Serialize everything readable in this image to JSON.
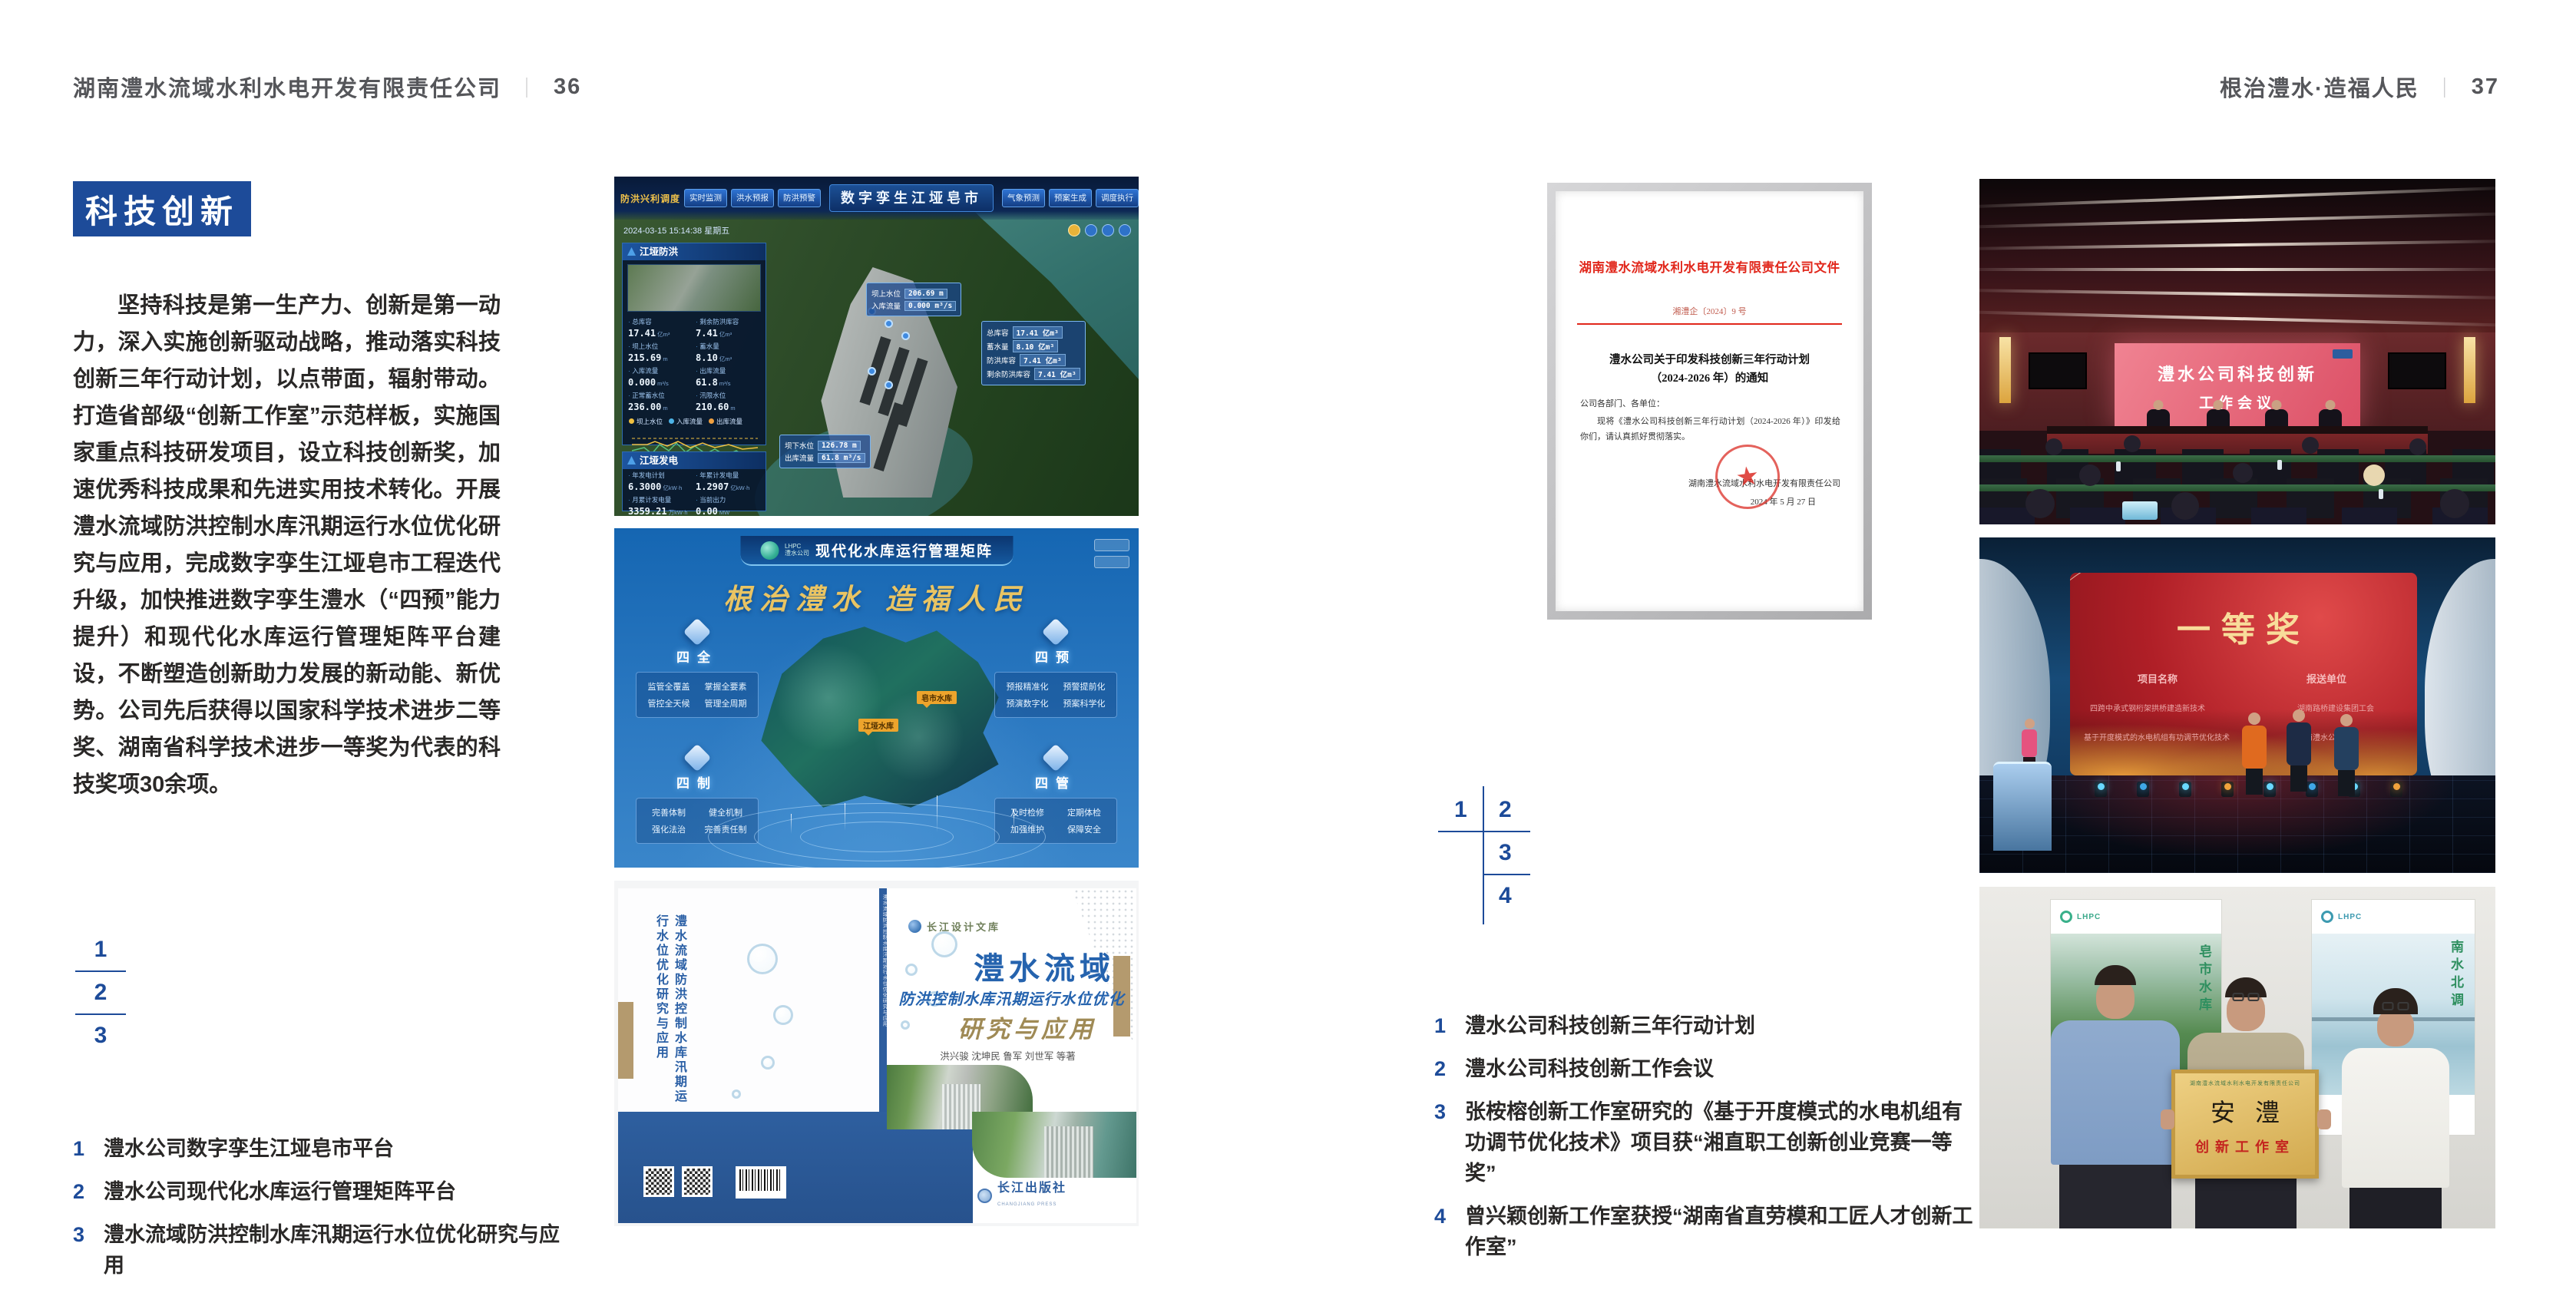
{
  "header_left": {
    "company": "湖南澧水流域水利水电开发有限责任公司",
    "separator": "｜",
    "page": "36"
  },
  "header_right": {
    "slogan": "根治澧水·造福人民",
    "separator": "｜",
    "page": "37"
  },
  "left_page": {
    "section_title": "科技创新",
    "paragraph": "坚持科技是第一生产力、创新是第一动力，深入实施创新驱动战略，推动落实科技创新三年行动计划，以点带面，辐射带动。打造省部级“创新工作室”示范样板，实施国家重点科技研发项目，设立科技创新奖，加速优秀科技成果和先进实用技术转化。开展澧水流域防洪控制水库汛期运行水位优化研究与应用，完成数字孪生江垭皂市工程迭代升级，加快推进数字孪生澧水（“四预”能力提升）和现代化水库运行管理矩阵平台建设，不断塑造创新助力发展的新动能、新优势。公司先后获得以国家科学技术进步二等奖、湖南省科学技术进步一等奖为代表的科技奖项30余项。",
    "figure_numbers": [
      "1",
      "2",
      "3"
    ],
    "captions": [
      {
        "num": "1",
        "text": "澧水公司数字孪生江垭皂市平台"
      },
      {
        "num": "2",
        "text": "澧水公司现代化水库运行管理矩阵平台"
      },
      {
        "num": "3",
        "text": "澧水流域防洪控制水库汛期运行水位优化研究与应用"
      }
    ]
  },
  "right_page": {
    "figure_numbers": [
      "1",
      "2",
      "3",
      "4"
    ],
    "captions": [
      {
        "num": "1",
        "text": "澧水公司科技创新三年行动计划"
      },
      {
        "num": "2",
        "text": "澧水公司科技创新工作会议"
      },
      {
        "num": "3",
        "text": "张桉榕创新工作室研究的《基于开度模式的水电机组有功调节优化技术》项目获“湘直职工创新创业竞赛一等奖”"
      },
      {
        "num": "4",
        "text": "曾兴颖创新工作室获授“湖南省直劳模和工匠人才创新工作室”"
      }
    ]
  },
  "fig_digital_twin": {
    "title": "数字孪生江垭皂市",
    "mode_label": "防洪兴利调度",
    "tabs_left": [
      "实时监测",
      "洪水预报",
      "防洪预警"
    ],
    "tabs_right": [
      "气象预测",
      "预案生成",
      "调度执行",
      "工程导览"
    ],
    "datetime": "2024-03-15 15:14:38 星期五",
    "panel_flood": {
      "title": "江垭防洪",
      "stats": [
        {
          "label": "总库容",
          "value": "17.41",
          "unit": "亿m³"
        },
        {
          "label": "剩余防洪库容",
          "value": "7.41",
          "unit": "亿m³"
        },
        {
          "label": "坝上水位",
          "value": "215.69",
          "unit": "m"
        },
        {
          "label": "蓄水量",
          "value": "8.10",
          "unit": "亿m³"
        },
        {
          "label": "入库流量",
          "value": "0.000",
          "unit": "m³/s"
        },
        {
          "label": "出库流量",
          "value": "61.8",
          "unit": "m³/s"
        },
        {
          "label": "正常蓄水位",
          "value": "236.00",
          "unit": "m"
        },
        {
          "label": "汛限水位",
          "value": "210.60",
          "unit": "m"
        }
      ],
      "legend": [
        "坝上水位",
        "入库流量",
        "出库流量"
      ]
    },
    "panel_power": {
      "title": "江垭发电",
      "stats": [
        {
          "label": "年发电计划",
          "value": "6.3000",
          "unit": "亿kW·h"
        },
        {
          "label": "年累计发电量",
          "value": "1.2907",
          "unit": "亿kW·h"
        },
        {
          "label": "月累计发电量",
          "value": "3359.21",
          "unit": "万kW·h"
        },
        {
          "label": "当前出力",
          "value": "0.00",
          "unit": "MW"
        }
      ]
    },
    "callout_upstream": [
      {
        "label": "坝上水位",
        "value": "206.69 m"
      },
      {
        "label": "入库流量",
        "value": "0.000 m³/s"
      }
    ],
    "callout_storage": [
      {
        "label": "总库容",
        "value": "17.41 亿m³"
      },
      {
        "label": "蓄水量",
        "value": "8.10 亿m³"
      },
      {
        "label": "防洪库容",
        "value": "7.41 亿m³"
      },
      {
        "label": "剩余防洪库容",
        "value": "7.41 亿m³"
      }
    ],
    "callout_downstream": [
      {
        "label": "坝下水位",
        "value": "126.78 m"
      },
      {
        "label": "出库流量",
        "value": "61.8 m³/s"
      }
    ]
  },
  "fig_matrix": {
    "logo_line1": "LHPC",
    "logo_line2": "澧水公司",
    "title": "现代化水库运行管理矩阵",
    "slogan": "根治澧水 造福人民",
    "modules": [
      {
        "name": "四全",
        "items": [
          "监管全覆盖",
          "掌握全要素",
          "管控全天候",
          "管理全周期"
        ]
      },
      {
        "name": "四制",
        "items": [
          "完善体制",
          "健全机制",
          "强化法治",
          "完善责任制"
        ]
      },
      {
        "name": "四预",
        "items": [
          "预报精准化",
          "预警提前化",
          "预演数字化",
          "预案科学化"
        ]
      },
      {
        "name": "四管",
        "items": [
          "及时检修",
          "定期体检",
          "加强维护",
          "保障安全"
        ]
      }
    ],
    "map_labels": [
      "皂市水库",
      "江垭水库"
    ]
  },
  "fig_book": {
    "series": "长江设计文库",
    "title_main": "澧水流域",
    "title_sub": "防洪控制水库汛期运行水位优化",
    "title_tail": "研究与应用",
    "authors": "洪兴骏  沈坤民  鲁军  刘世军  等著",
    "publisher": "长江出版社",
    "publisher_en": "CHANGJIANG PRESS",
    "spine_title": "澧水流域防洪控制水库汛期运行水位优化研究与应用"
  },
  "fig_meeting": {
    "screen_line1": "澧水公司科技创新",
    "screen_line2": "工作会议"
  },
  "fig_award": {
    "title": "一等奖",
    "col1_header": "项目名称",
    "col2_header": "报送单位",
    "rows": [
      {
        "project": "四跨中承式钢桁架拱桥建造新技术",
        "org": "湖南路桥建设集团工会"
      },
      {
        "project": "基于开度模式的水电机组有功调节优化技术",
        "org": "湖南澧水公司工会"
      }
    ]
  },
  "fig_workshop": {
    "plaque_header": "湖南澧水流域水利水电开发有限责任公司",
    "plaque_title": "安澧",
    "plaque_subtitle": "创新工作室",
    "poster_left_text": "皂市水库",
    "poster_right_text": "南水北调",
    "poster_logo": "LHPC"
  },
  "fig_document": {
    "header": "湖南澧水流域水利水电开发有限责任公司文件",
    "doc_no": "湘澧企〔2024〕9 号",
    "title_line1": "澧水公司关于印发科技创新三年行动计划",
    "title_line2": "（2024-2026 年）的通知",
    "salutation": "公司各部门、各单位：",
    "body": "现将《澧水公司科技创新三年行动计划（2024-2026 年）》印发给你们，请认真抓好贯彻落实。",
    "star": "★",
    "signer": "湖南澧水流域水利水电开发有限责任公司",
    "date": "2024 年 5 月 27 日"
  }
}
